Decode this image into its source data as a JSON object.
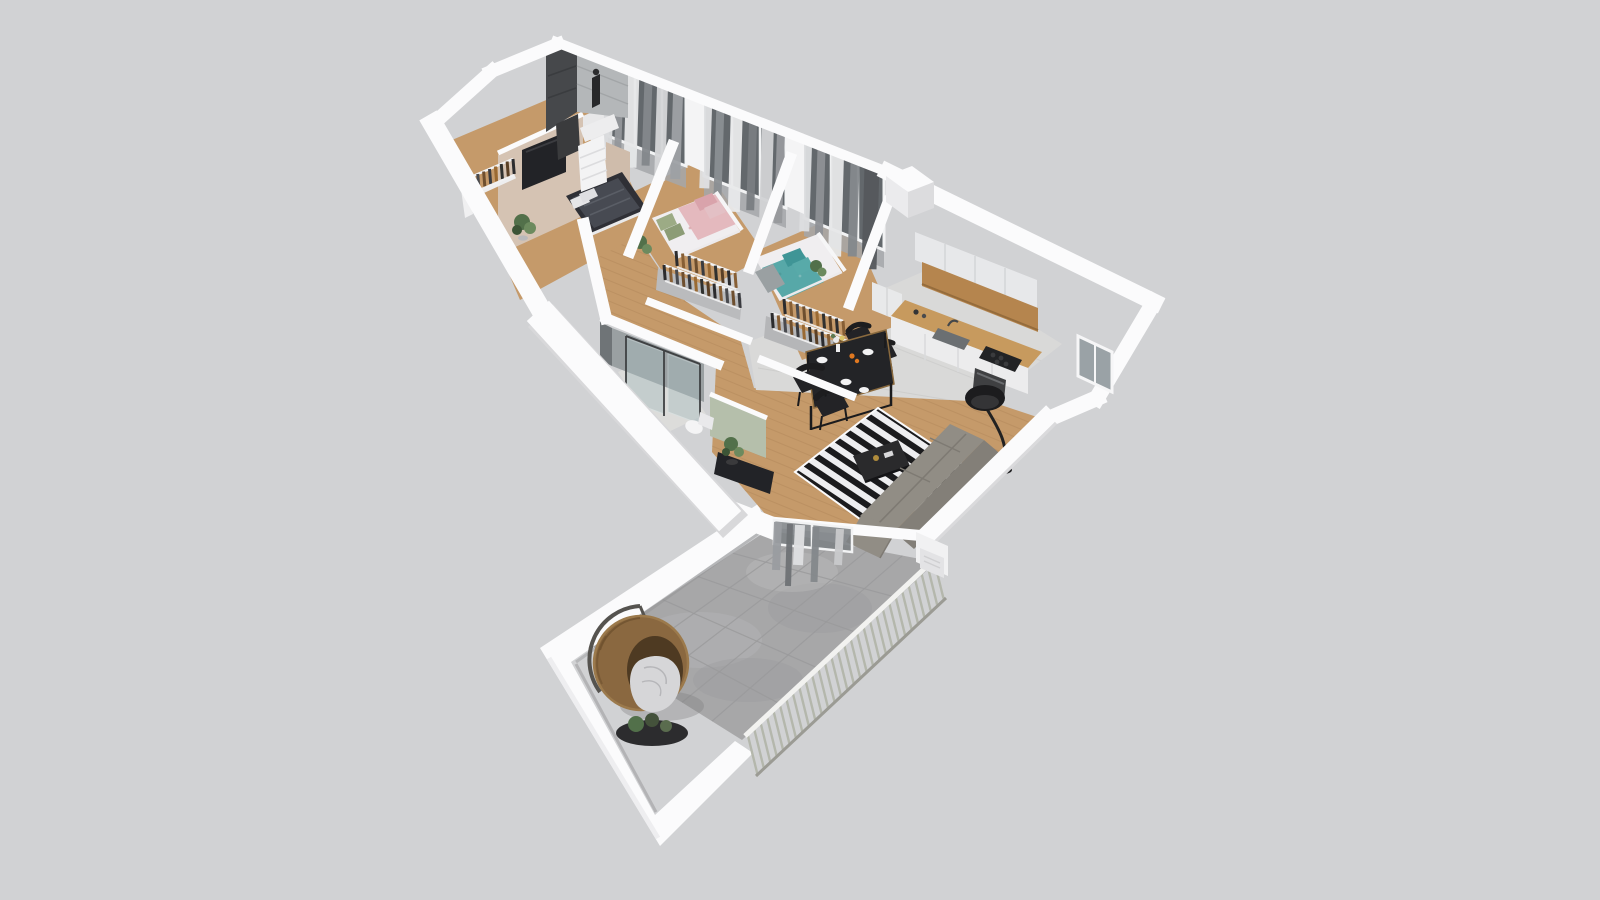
{
  "scene": {
    "description": "3D axonometric dollhouse floor-plan rendering of an apartment on a plain gray backdrop",
    "background": "#d1d2d4"
  },
  "palette": {
    "background": "#d1d2d4",
    "wallWhite": "#fbfbfc",
    "wallShade": "#e3e3e5",
    "wallDark": "#d0d0d2",
    "beigeWall": "#d5c3b3",
    "floorWood": "#c59a6a",
    "plankLine": "#b2875b",
    "kitchenTile": "#d9d9d8",
    "bathTile": "#dcdcda",
    "concrete": "#a7a7a8",
    "concreteLight": "#b9b9ba",
    "grout": "#9a9a9b",
    "rugBlack": "#1b1b1d",
    "rugWhite": "#eeeef0",
    "sofaSeat": "#918d85",
    "sofaBack": "#837f78",
    "coffeeTable": "#2a2a2c",
    "diningTable": "#232427",
    "chairBlack": "#232326",
    "tvScreen": "#222327",
    "greenWall": "#b5bfab",
    "bedDark": "#2f3036",
    "bedDarkTop": "#474a52",
    "floralWhite": "#f0eef0",
    "pinkBlanket": "#e4b9be",
    "pinkPillow": "#d9a3ab",
    "greenPillow": "#9cab85",
    "tealBlanket": "#57a8a8",
    "tealPillow": "#3f9596",
    "grayBlanket": "#9aa0a2",
    "counterWood": "#c79a5e",
    "panelWood": "#b5854e",
    "cabinetFace": "#e7e8ea",
    "applianceDark": "#3f4042",
    "glassDark": "#63686c",
    "glassPane": "#9aa2a6",
    "curtainLight": "#e7e8e9",
    "curtainMid": "#9a9da1",
    "curtainDark": "#7a7e82",
    "darkTile": "#46484b",
    "subwayTile": "#b4b7b9",
    "rattan": "#8a6840",
    "rattanInner": "#4e3a22",
    "blanketWhite": "#d6d6d8",
    "railSlat": "#b4b7ac",
    "plantGreen": "#52704a",
    "plantLight": "#6c8a5e",
    "lampBlack": "#1c1c1e",
    "candleOrange": "#e07820",
    "plateWhite": "#f2f2f3",
    "steel": "#3f4143"
  },
  "objects": [
    "hanging-egg-chair",
    "balcony-railing",
    "concrete-balcony-floor",
    "striped-rug",
    "corner-sofa",
    "coffee-table",
    "dining-table",
    "dining-chairs",
    "floor-lamp",
    "kitchen-counter",
    "wall-cabinets",
    "cooktop",
    "oven",
    "sink",
    "bed-dark",
    "bed-pink",
    "bed-teal",
    "open-wardrobes",
    "shower-cabin",
    "toilet",
    "tv-panel",
    "plants",
    "curtained-windows",
    "wood-flooring"
  ]
}
